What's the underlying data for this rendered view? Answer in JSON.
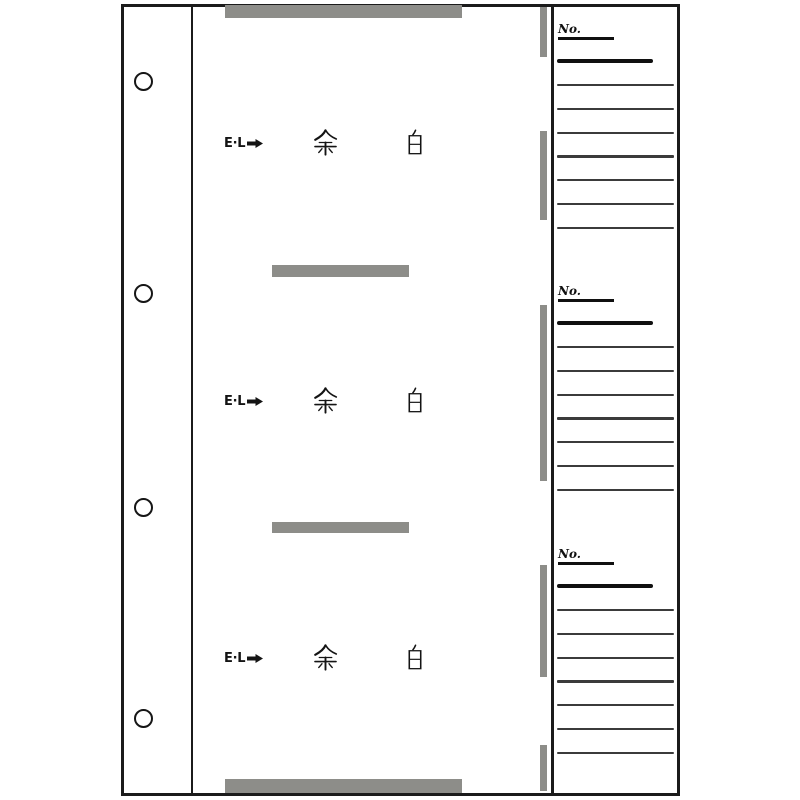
{
  "page": {
    "background": "#ffffff",
    "sheet_border_color": "#1b1b1b"
  },
  "colors": {
    "tape_gray": "#8d8d89",
    "ruled_line": "#3b3b3b",
    "ink_black": "#101010"
  },
  "left_strip": {
    "holes_y": [
      81,
      293,
      507,
      718
    ]
  },
  "main": {
    "rows": [
      {
        "marker": "E·L",
        "arrow": "right-arrow",
        "kanji": "余 白",
        "y": 143
      },
      {
        "marker": "E·L",
        "arrow": "right-arrow",
        "kanji": "余 白",
        "y": 401
      },
      {
        "marker": "E·L",
        "arrow": "right-arrow",
        "kanji": "余 白",
        "y": 658
      }
    ],
    "tapes": [
      {
        "x": 225,
        "y": 5,
        "w": 237,
        "h": 13
      },
      {
        "x": 272,
        "y": 265,
        "w": 137,
        "h": 12
      },
      {
        "x": 272,
        "y": 522,
        "w": 137,
        "h": 11
      },
      {
        "x": 225,
        "y": 779,
        "w": 237,
        "h": 14
      }
    ]
  },
  "memo": {
    "sections": [
      {
        "no_label": "No.",
        "top": 25,
        "ruled_lines": 7
      },
      {
        "no_label": "No.",
        "top": 287,
        "ruled_lines": 7
      },
      {
        "no_label": "No.",
        "top": 550,
        "ruled_lines": 7
      }
    ],
    "ticks": [
      {
        "y": 7,
        "h": 50
      },
      {
        "y": 131,
        "h": 89
      },
      {
        "y": 305,
        "h": 176
      },
      {
        "y": 565,
        "h": 112
      },
      {
        "y": 745,
        "h": 46
      }
    ]
  }
}
